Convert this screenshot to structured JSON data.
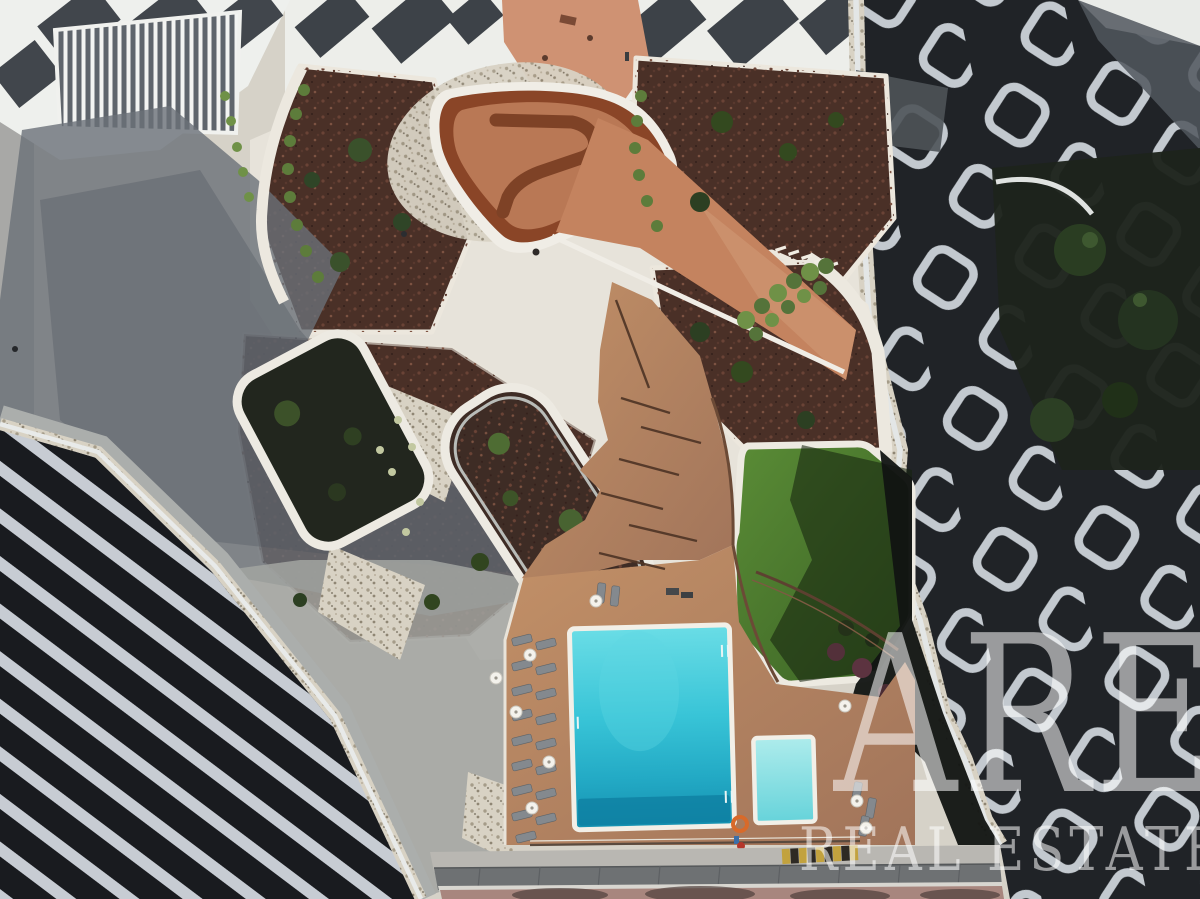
{
  "scene": {
    "type": "aerial-drone-photograph",
    "subject": "modern residential complex inner courtyard",
    "features": [
      "swimming-pool",
      "kids-pool",
      "sun-deck-with-loungers",
      "parasols",
      "lawn",
      "terracotta-play-structure",
      "planters",
      "garden-beds",
      "ramp-walkways",
      "zigzag-balcony-facade",
      "honeycomb-balcony-facade",
      "building-shadow"
    ]
  },
  "watermark": {
    "line1": "ARE",
    "line2": "REAL ESTATE"
  },
  "palette": {
    "plaza": "#d6d2c8",
    "concrete_bright": "#e7e3da",
    "mulch": "#4a3027",
    "terracotta_floor": "#b97855",
    "terracotta_wall": "#8a4527",
    "terracotta_ramp": "#c4835f",
    "lawn": "#4c7a2e",
    "deck": "#b5825f",
    "pool_water": "#2cbad1",
    "kids_pool_water": "#8fe0e4",
    "coping_white": "#f2efe7",
    "building_dark": "#202327",
    "balcony_white": "#c3c9cf",
    "facade_stripe": "#c7ccd3",
    "sidewalk_gray": "#6e7173",
    "pavement_red": "#a8867e",
    "shadow": "#6a7078",
    "watermark_white": "rgba(255,255,255,0.55)"
  }
}
